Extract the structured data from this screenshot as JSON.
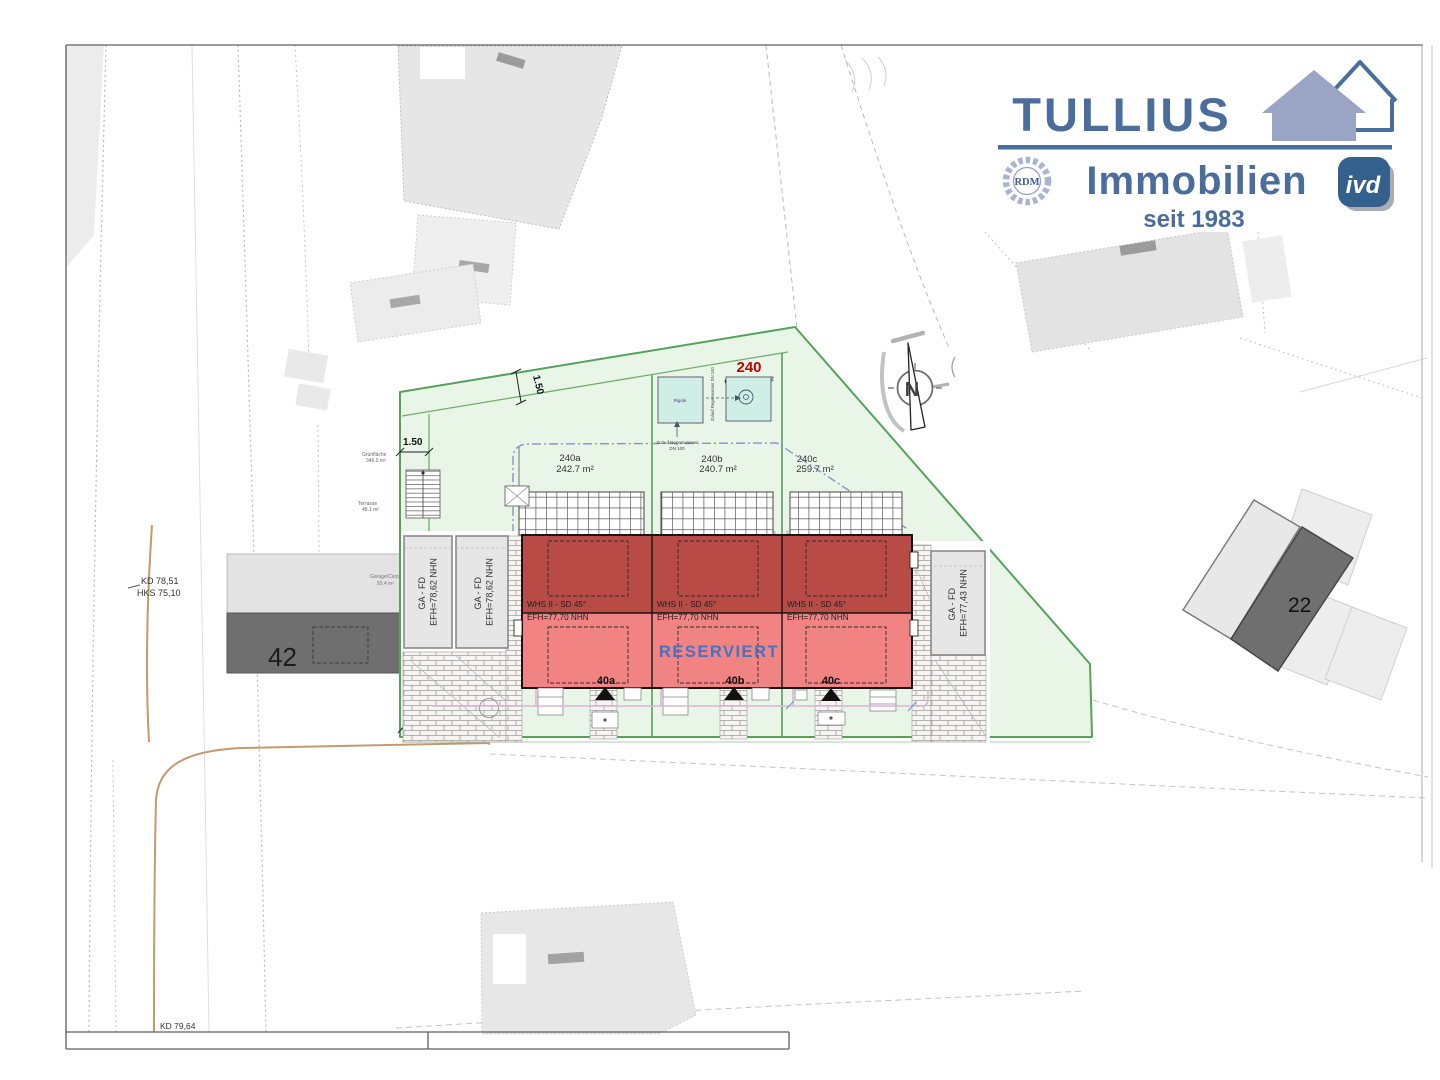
{
  "colors": {
    "brand": "#4a6d9c",
    "brand_house": "#9aa5c6",
    "ivd_bg": "#33608c",
    "house_top": "#b94b47",
    "house_bottom": "#f28383",
    "reserved": "#4472c4",
    "plot_green": "#55a25c",
    "plot_green_fill": "#e9f5e7",
    "plot_number_red": "#c00000",
    "water_box": "#cfeee6",
    "utility_tan": "#c49a6c",
    "walk_pink": "#dcb4d8",
    "envelope_blue": "#8a94c2"
  },
  "logo": {
    "brand": "TULLIUS",
    "division": "Immobilien",
    "since": "seit 1983",
    "rdm_badge": "RDM",
    "ivd_badge": "ivd"
  },
  "plot": {
    "number": "240",
    "area": "ca. 743 m²",
    "subplots": [
      {
        "id": "240a",
        "area": "242.7 m²"
      },
      {
        "id": "240b",
        "area": "240.7 m²"
      },
      {
        "id": "240c",
        "area": "259.7 m²"
      }
    ],
    "boundary_mark": "R"
  },
  "houses": {
    "reserved": "RESERVIERT",
    "units": [
      {
        "id": "40a",
        "type": "WHS II - SD 45°",
        "level": "EFH=77,70 NHN"
      },
      {
        "id": "40b",
        "type": "WHS II - SD 45°",
        "level": "EFH=77,70 NHN"
      },
      {
        "id": "40c",
        "type": "WHS II - SD 45°",
        "level": "EFH=77,70 NHN"
      }
    ]
  },
  "garages": {
    "left_a": {
      "line1": "GA - FD",
      "line2": "EFH=78,62 NHN"
    },
    "left_b": {
      "line1": "GA - FD",
      "line2": "EFH=78,62 NHN"
    },
    "right": {
      "line1": "GA - FD",
      "line2": "EFH=77,43 NHN"
    }
  },
  "neighbors": {
    "left_number": "42",
    "left_note1": "Garage/Carport",
    "left_note2": "93.4 m²",
    "right_number": "22"
  },
  "levels": {
    "kd_top": "KD 78,51",
    "hks": "HKS 75,10",
    "kd_bottom": "KD 79,64"
  },
  "dimensions": {
    "strip_left": "1.50",
    "strip_top": "1.50",
    "drive_width": "3.00"
  },
  "drainage": {
    "basin_label": "Rigole",
    "inflow_line1": "Zulauf Regenwasser",
    "inflow_line2": "DN 100",
    "inflow_vertical": "Zulauf Regenwasser DN 100"
  },
  "outdoor": {
    "green_label": "Grünfläche",
    "green_area": "346.0 m²",
    "terrace_label": "Terrasse",
    "terrace_area": "48.1 m²"
  },
  "compass": {
    "north": "N"
  }
}
